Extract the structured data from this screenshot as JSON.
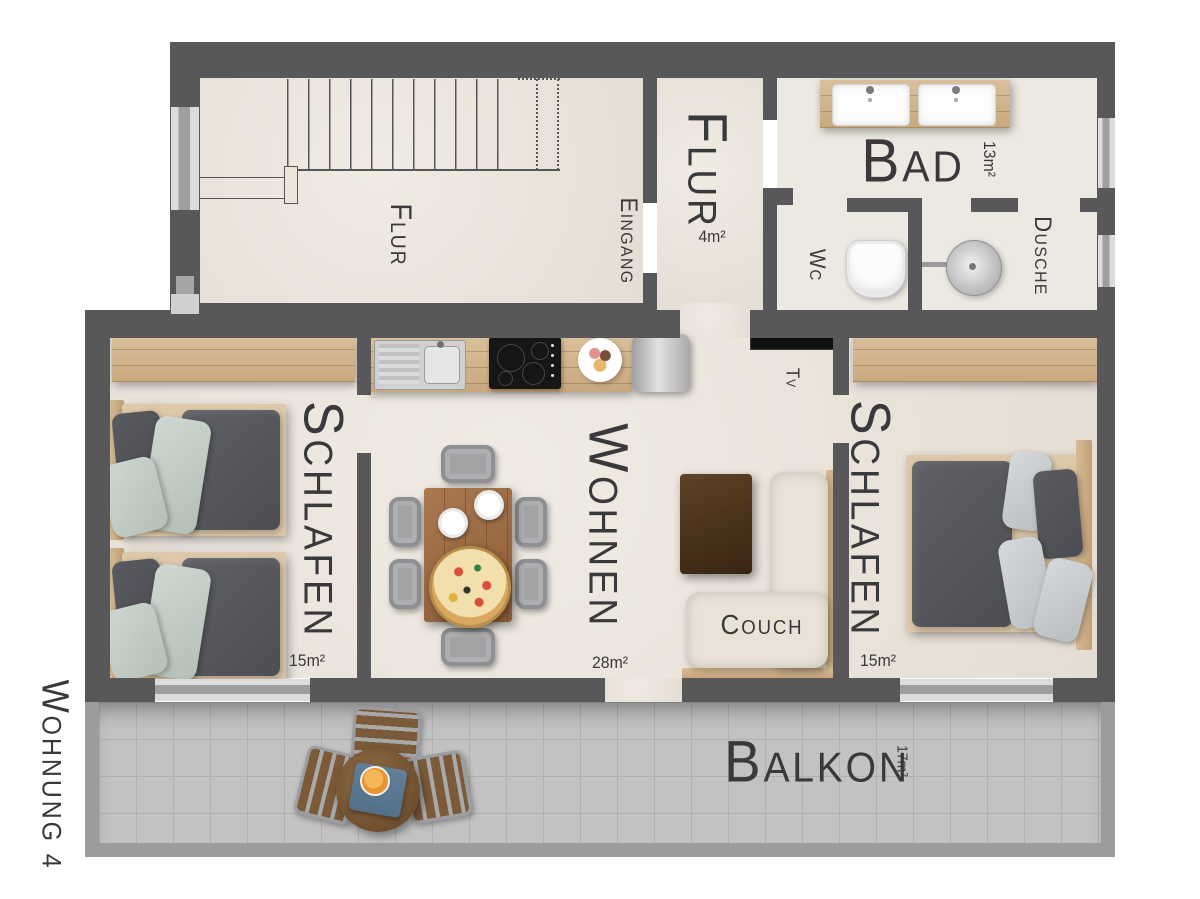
{
  "apartment": {
    "label": "WOHNUNG 4"
  },
  "rooms": {
    "stairwell": {
      "label": "FLUR"
    },
    "entrance": {
      "label": "EINGANG"
    },
    "hallway": {
      "label": "FLUR",
      "area": "4m²"
    },
    "bathroom": {
      "label": "BAD",
      "area": "13m²",
      "wc": "WC",
      "shower": "DUSCHE"
    },
    "bedroom_left": {
      "label": "SCHLAFEN",
      "area": "15m²"
    },
    "living_room": {
      "label": "WOHNEN",
      "area": "28m²",
      "couch": "COUCH",
      "tv": "TV"
    },
    "bedroom_right": {
      "label": "SCHLAFEN",
      "area": "15m²"
    },
    "balcony": {
      "label": "BALKON",
      "area": "17m²"
    }
  },
  "colors": {
    "wall": "#58585a",
    "railing": "#9c9c9c",
    "floor": "#ebe4da",
    "bath_floor": "#ece8e2",
    "balcony_floor": "#c2c2c2",
    "window_light": "#dcdcdc",
    "window_mid": "#9f9fa0",
    "wood": "#cfae85",
    "dark_wood": "#4a3420",
    "duvet": "#56575c",
    "pillow_sage": "#c4cec8",
    "pillow_gray": "#c9cdcf",
    "couch": "#e8e3d6",
    "tv": "#101010",
    "text": "#39393b"
  }
}
